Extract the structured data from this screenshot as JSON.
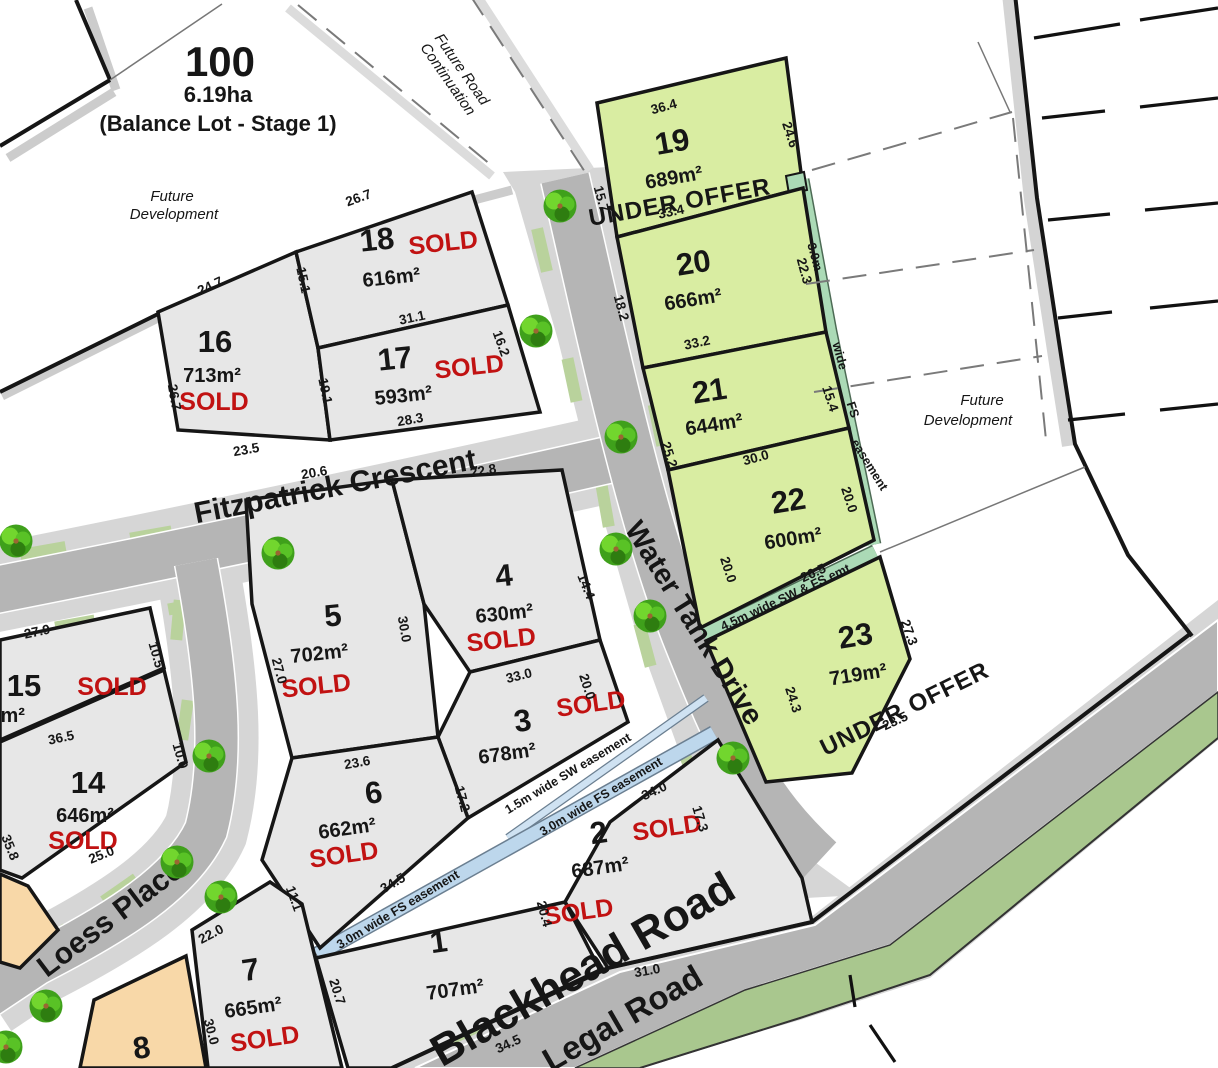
{
  "colors": {
    "lot_gray": "#e7e7e7",
    "lot_green": "#d9eda2",
    "lot_orange": "#f8d8a8",
    "road": "#b5b5b5",
    "verge": "#d6d6d6",
    "patch": "#b9d29c",
    "legal_green": "#a9c78e",
    "easement_teal": "#abdab6",
    "easement_blue": "#bdd7ec",
    "easement_blue_light": "#cfe2f2",
    "sold_red": "#c11212",
    "line": "#161616"
  },
  "balance_lot": {
    "number": "100",
    "area": "6.19ha",
    "note": "(Balance Lot - Stage 1)"
  },
  "labels": {
    "future_dev_1": "Future",
    "future_dev_2": "Development",
    "future_road_1": "Future Road",
    "future_road_2": "Continuation"
  },
  "streets": {
    "fitzpatrick": "Fitzpatrick Crescent",
    "water_tank": "Water Tank Drive",
    "loess": "Loess Place",
    "blackhead": "Blackhead Road",
    "legal": "Legal Road"
  },
  "easements": {
    "e3m_w1": "3.0m",
    "e3m_w2": "wide",
    "e3m_w3": "FS",
    "e3m_w4": "easement",
    "sw_fs_45": "4.5m wide SW & FS emt",
    "sw_15": "1.5m wide SW easement",
    "fs_30": "3.0m wide FS easement"
  },
  "lots": [
    {
      "num": "1",
      "area": "707m²",
      "status": "SOLD"
    },
    {
      "num": "2",
      "area": "687m²",
      "status": "SOLD"
    },
    {
      "num": "3",
      "area": "678m²",
      "status": "SOLD"
    },
    {
      "num": "4",
      "area": "630m²",
      "status": "SOLD"
    },
    {
      "num": "5",
      "area": "702m²",
      "status": "SOLD"
    },
    {
      "num": "6",
      "area": "662m²",
      "status": "SOLD"
    },
    {
      "num": "7",
      "area": "665m²",
      "status": "SOLD"
    },
    {
      "num": "8",
      "area": "",
      "status": ""
    },
    {
      "num": "14",
      "area": "646m²",
      "status": "SOLD"
    },
    {
      "num": "15",
      "area": "650m²",
      "status": "SOLD"
    },
    {
      "num": "16",
      "area": "713m²",
      "status": "SOLD"
    },
    {
      "num": "17",
      "area": "593m²",
      "status": "SOLD"
    },
    {
      "num": "18",
      "area": "616m²",
      "status": "SOLD"
    },
    {
      "num": "19",
      "area": "689m²",
      "status": "UNDER OFFER"
    },
    {
      "num": "20",
      "area": "666m²",
      "status": ""
    },
    {
      "num": "21",
      "area": "644m²",
      "status": ""
    },
    {
      "num": "22",
      "area": "600m²",
      "status": ""
    },
    {
      "num": "23",
      "area": "719m²",
      "status": "UNDER OFFER"
    }
  ],
  "measurements": [
    "26.7",
    "24.7",
    "15.1",
    "31.1",
    "16.2",
    "19.1",
    "28.3",
    "23.5",
    "26.7",
    "36.4",
    "24.6",
    "15.7",
    "33.4",
    "22.3",
    "18.2",
    "33.2",
    "15.4",
    "25.2",
    "30.0",
    "20.0",
    "20.0",
    "26.5",
    "27.3",
    "24.3",
    "23.5",
    "22.8",
    "14.4",
    "30.0",
    "33.0",
    "20.0",
    "27.0",
    "20.6",
    "23.6",
    "17.2",
    "34.0",
    "20.4",
    "31.0",
    "17.3",
    "34.5",
    "34.5",
    "20.7",
    "30.0",
    "11.1",
    "22.0",
    "25.0",
    "36.5",
    "10.0",
    "10.5",
    "27.9",
    "35.8"
  ]
}
